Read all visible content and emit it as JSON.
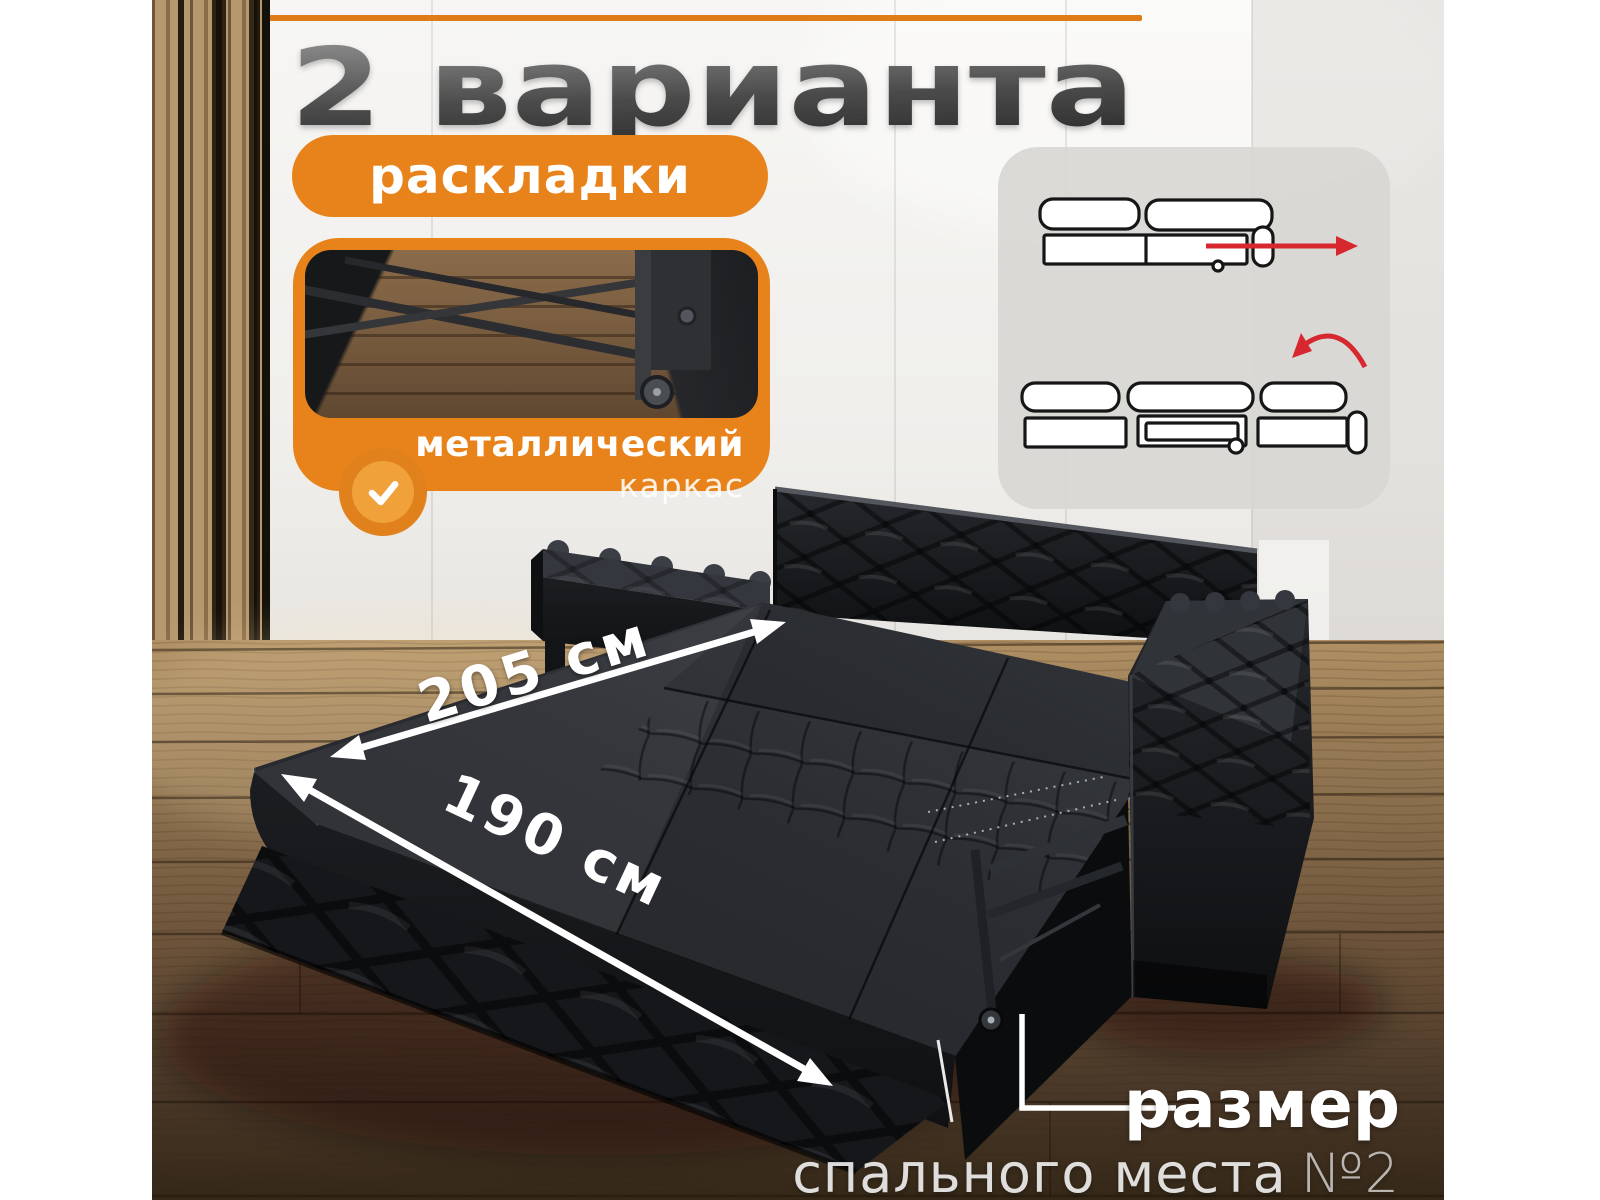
{
  "title": "2 варианта",
  "badge": {
    "label": "раскладки"
  },
  "frame_card": {
    "title": "металлический",
    "subtitle": "каркас"
  },
  "dimensions": {
    "length": "205 см",
    "width": "190 см"
  },
  "caption": {
    "title": "размер",
    "subtitle": "спального места",
    "number": "№2"
  },
  "icons": {
    "check_icon": "✓",
    "pull_out_arrow_icon": "→",
    "fold_over_arrow_icon": "⤵",
    "dimension_arrow_icon": "↔"
  },
  "colors": {
    "accent_orange": "#E8831C",
    "accent_orange_light": "#F0A13A",
    "red_arrow": "#D7282F",
    "title_gray_top": "#9A9A9A",
    "title_gray_bottom": "#303030",
    "dimension_white": "#FFFFFF"
  }
}
